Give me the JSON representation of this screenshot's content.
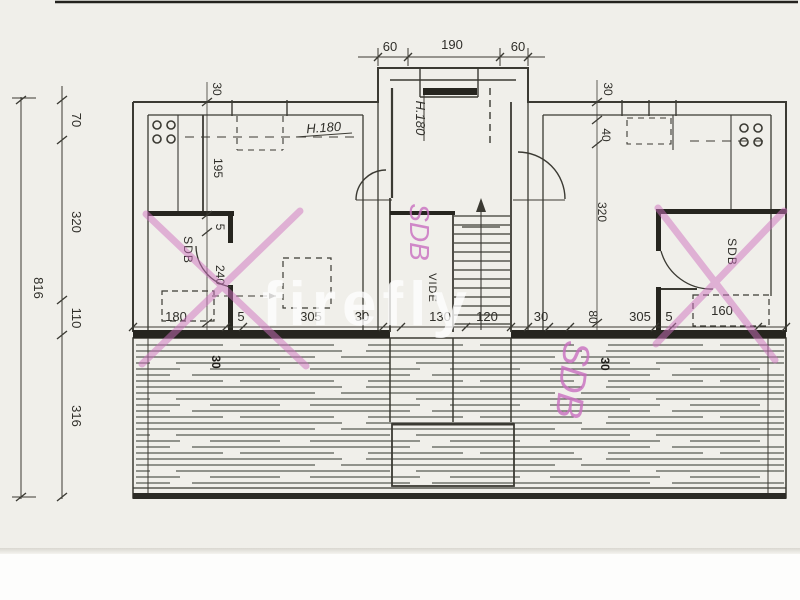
{
  "watermark": {
    "text": "firefly"
  },
  "rooms": {
    "left_bath": "SDB",
    "right_bath": "SDB",
    "void": "VIDE"
  },
  "annotations": {
    "h180_left": "H.180",
    "h180_bay": "H.180",
    "pink_sdb_center": "SDB",
    "pink_sdb_right": "SDB"
  },
  "dimensions": {
    "top": [
      "60",
      "190",
      "60"
    ],
    "overall_height": "816",
    "left_chain": [
      "70",
      "320",
      "110",
      "316"
    ],
    "left_interior": [
      "30",
      "195",
      "5",
      "240"
    ],
    "right_interior": [
      "30",
      "40",
      "320"
    ],
    "bottom_row": [
      "180",
      "5",
      "305",
      "30",
      "130",
      "120",
      "30",
      "80",
      "305",
      "5",
      "160"
    ],
    "wall_marks": [
      "30",
      "30"
    ]
  },
  "colors": {
    "paper": "#f0efea",
    "ink": "#3b3a33",
    "wall_fill": "#26251f",
    "hatch": "#565a52",
    "pink": "#cf72c0",
    "watermark": "#ffffff"
  }
}
